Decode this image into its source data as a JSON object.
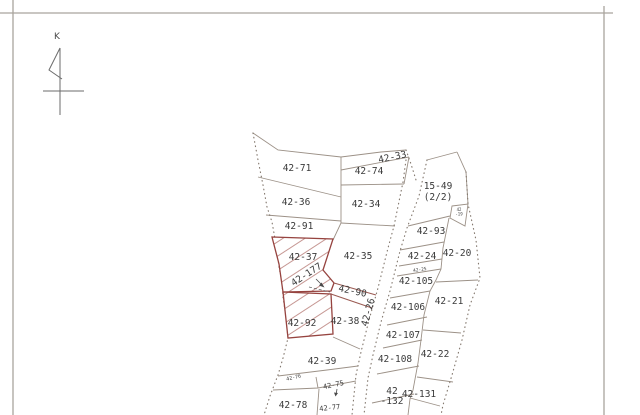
{
  "document": {
    "kind": "scanned cadastral parcel map",
    "north_label": "K",
    "highlighted_parcels": [
      "42-37",
      "42-177",
      "42-92"
    ],
    "road_parcel": "42-26"
  },
  "colors": {
    "boundary": "#9c9187",
    "dotted_boundary": "#84796f",
    "highlight_red": "#96433f",
    "hatch_red": "#c08b87",
    "text": "#3a3a3a",
    "frame": "#a9a49d",
    "paper": "#ffffff"
  },
  "labels": [
    {
      "id": "42-71",
      "lines": [
        "42-71"
      ],
      "x": 297,
      "y": 171,
      "size": 9.5,
      "rot": 0,
      "lh": 11
    },
    {
      "id": "42-36",
      "lines": [
        "42-36"
      ],
      "x": 296,
      "y": 205,
      "size": 9.5,
      "rot": 0,
      "lh": 11
    },
    {
      "id": "42-91",
      "lines": [
        "42-91"
      ],
      "x": 299,
      "y": 229,
      "size": 9.5,
      "rot": 0,
      "lh": 11
    },
    {
      "id": "42-37",
      "lines": [
        "42-37"
      ],
      "x": 303,
      "y": 260,
      "size": 9.5,
      "rot": 0,
      "lh": 11
    },
    {
      "id": "42-177",
      "lines": [
        "42-177"
      ],
      "x": 308,
      "y": 277,
      "size": 9.5,
      "rot": -33,
      "lh": 11
    },
    {
      "id": "42-92",
      "lines": [
        "42-92"
      ],
      "x": 302,
      "y": 326,
      "size": 9.5,
      "rot": 0,
      "lh": 11
    },
    {
      "id": "42-39",
      "lines": [
        "42-39"
      ],
      "x": 322,
      "y": 364,
      "size": 9.5,
      "rot": 0,
      "lh": 11
    },
    {
      "id": "42-76",
      "lines": [
        "42-76"
      ],
      "x": 294,
      "y": 379,
      "size": 5,
      "rot": -12,
      "lh": 6
    },
    {
      "id": "42-75",
      "lines": [
        "42-75"
      ],
      "x": 334,
      "y": 387,
      "size": 7,
      "rot": -12,
      "lh": 8
    },
    {
      "id": "42-78",
      "lines": [
        "42-78"
      ],
      "x": 293,
      "y": 408,
      "size": 9.5,
      "rot": 0,
      "lh": 11
    },
    {
      "id": "42-77",
      "lines": [
        "42-77"
      ],
      "x": 330,
      "y": 410,
      "size": 7,
      "rot": -6,
      "lh": 8
    },
    {
      "id": "42-33",
      "lines": [
        "42-33"
      ],
      "x": 393,
      "y": 160,
      "size": 9.5,
      "rot": -12,
      "lh": 11
    },
    {
      "id": "42-74",
      "lines": [
        "42-74"
      ],
      "x": 369,
      "y": 174,
      "size": 9.5,
      "rot": 0,
      "lh": 11
    },
    {
      "id": "42-34",
      "lines": [
        "42-34"
      ],
      "x": 366,
      "y": 207,
      "size": 9.5,
      "rot": 0,
      "lh": 11
    },
    {
      "id": "42-35",
      "lines": [
        "42-35"
      ],
      "x": 358,
      "y": 259,
      "size": 9.5,
      "rot": 0,
      "lh": 11
    },
    {
      "id": "42-90",
      "lines": [
        "42-90"
      ],
      "x": 352,
      "y": 294,
      "size": 9.5,
      "rot": 12,
      "lh": 11
    },
    {
      "id": "42-38",
      "lines": [
        "42-38"
      ],
      "x": 345,
      "y": 324,
      "size": 9.5,
      "rot": 0,
      "lh": 11
    },
    {
      "id": "42-26",
      "lines": [
        "42-26"
      ],
      "x": 371,
      "y": 313,
      "size": 9.5,
      "rot": -75,
      "lh": 11
    },
    {
      "id": "15-49",
      "lines": [
        "15-49",
        "(2/2)"
      ],
      "x": 438,
      "y": 189,
      "size": 9.5,
      "rot": 0,
      "lh": 11
    },
    {
      "id": "42-19",
      "lines": [
        "42",
        "-19"
      ],
      "x": 459,
      "y": 211,
      "size": 4,
      "rot": 0,
      "lh": 4.5
    },
    {
      "id": "42-93",
      "lines": [
        "42-93"
      ],
      "x": 431,
      "y": 234,
      "size": 9.5,
      "rot": 0,
      "lh": 11
    },
    {
      "id": "42-20",
      "lines": [
        "42-20"
      ],
      "x": 457,
      "y": 256,
      "size": 9.5,
      "rot": 0,
      "lh": 11
    },
    {
      "id": "42-24",
      "lines": [
        "42-24"
      ],
      "x": 422,
      "y": 259,
      "size": 9.5,
      "rot": 0,
      "lh": 11
    },
    {
      "id": "42-25",
      "lines": [
        "42-25"
      ],
      "x": 420,
      "y": 271,
      "size": 4.5,
      "rot": -8,
      "lh": 5
    },
    {
      "id": "42-105",
      "lines": [
        "42-105"
      ],
      "x": 416,
      "y": 284,
      "size": 9.5,
      "rot": 0,
      "lh": 11
    },
    {
      "id": "42-106",
      "lines": [
        "42-106"
      ],
      "x": 408,
      "y": 310,
      "size": 9.5,
      "rot": 0,
      "lh": 11
    },
    {
      "id": "42-21",
      "lines": [
        "42-21"
      ],
      "x": 449,
      "y": 304,
      "size": 9.5,
      "rot": 0,
      "lh": 11
    },
    {
      "id": "42-107",
      "lines": [
        "42-107"
      ],
      "x": 403,
      "y": 338,
      "size": 9.5,
      "rot": 0,
      "lh": 11
    },
    {
      "id": "42-108",
      "lines": [
        "42-108"
      ],
      "x": 395,
      "y": 362,
      "size": 9.5,
      "rot": 0,
      "lh": 11
    },
    {
      "id": "42-22",
      "lines": [
        "42-22"
      ],
      "x": 435,
      "y": 357,
      "size": 9.5,
      "rot": 0,
      "lh": 11
    },
    {
      "id": "42-132",
      "lines": [
        "42",
        "-132"
      ],
      "x": 392,
      "y": 394,
      "size": 9.5,
      "rot": 0,
      "lh": 10
    },
    {
      "id": "42-131",
      "lines": [
        "42-131"
      ],
      "x": 419,
      "y": 397,
      "size": 9.5,
      "rot": 0,
      "lh": 11
    }
  ]
}
